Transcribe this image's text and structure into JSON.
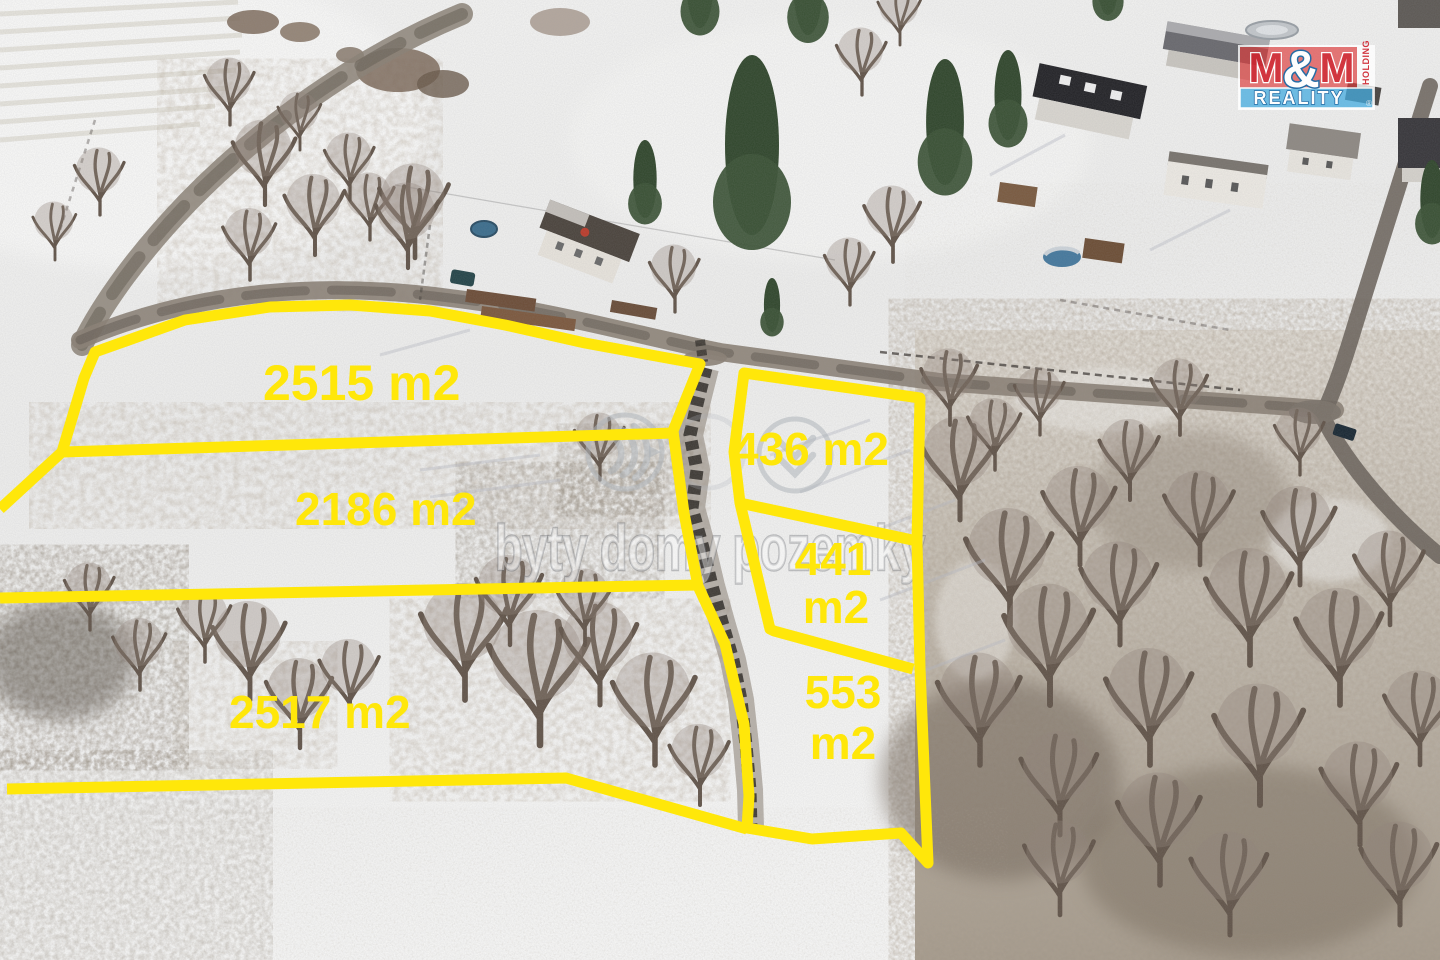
{
  "scene": {
    "description": "Winter aerial drone photograph of snow-covered land parcels outlined with thick yellow boundary lines. Three large parcels on the left (2515 m2, 2186 m2, 2517 m2) and three smaller parcels on the right (436 m2, 441 m2, 553 m2) separated by a dark dirt track. A road with houses and gardens runs along the top, bare-tree woodland fills the right side, a real-estate watermark sits across the middle and an M&M REALITY HOLDING logo is in the top right corner."
  },
  "plots": [
    {
      "name": "plot-2515",
      "lines": [
        "2515 m2"
      ]
    },
    {
      "name": "plot-2186",
      "lines": [
        "2186 m2"
      ]
    },
    {
      "name": "plot-2517",
      "lines": [
        "2517 m2"
      ]
    },
    {
      "name": "plot-436",
      "lines": [
        "436 m2"
      ]
    },
    {
      "name": "plot-441",
      "lines": [
        "441",
        "m2"
      ]
    },
    {
      "name": "plot-553",
      "lines": [
        "553",
        "m2"
      ]
    }
  ],
  "watermark": {
    "text": "byty domy pozemky"
  },
  "logo": {
    "m_left": "M",
    "ampersand": "&",
    "m_right": "M",
    "holding": "HOLDING",
    "reality": "REALITY",
    "registered": "®"
  },
  "colors": {
    "boundary_yellow": "#ffe70a",
    "logo_red": "#cf2630",
    "logo_blue_dark": "#14629f",
    "watermark_fill": "rgba(255,255,255,0.38)",
    "watermark_stroke": "rgba(110,112,118,0.40)"
  }
}
